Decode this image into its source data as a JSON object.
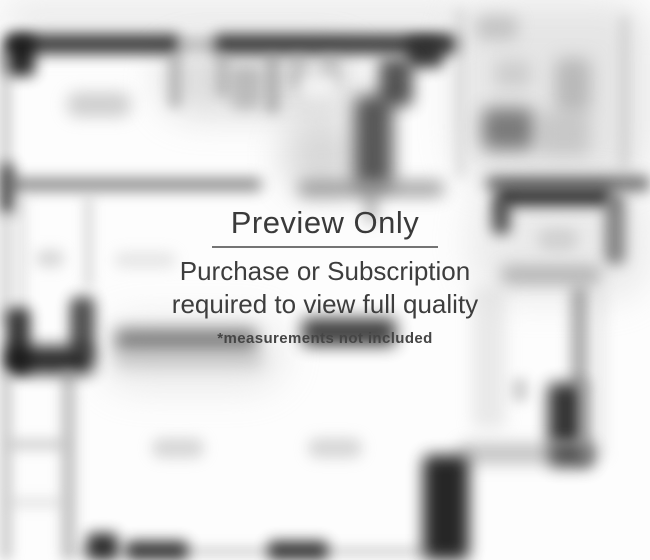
{
  "watermark": {
    "title": "Preview Only",
    "subtitle_line1": "Purchase or Subscription",
    "subtitle_line2": "required to view full quality",
    "note": "*measurements not included"
  },
  "colors": {
    "watermark_text": "#3b3b3b",
    "divider": "#5c5c5c",
    "background": "#fdfdfd",
    "wall_dark": "#1f1f1f",
    "wall_gray": "#8c8c8c"
  },
  "floorplan": {
    "description": "Blurred black-and-white apartment floor plan (preview quality)",
    "shapes": [
      {
        "n": "fog-top-strip",
        "x": 0,
        "y": 0,
        "w": 470,
        "h": 36,
        "c": "#d9d9d9",
        "o": 0.55,
        "b": 18,
        "r": 40
      },
      {
        "n": "fog-top-right",
        "x": 455,
        "y": 0,
        "w": 195,
        "h": 185,
        "c": "#c9c9c9",
        "o": 0.45,
        "b": 18,
        "r": 40
      },
      {
        "n": "fog-closet-area",
        "x": 160,
        "y": 48,
        "w": 200,
        "h": 68,
        "c": "#bdbdbd",
        "o": 0.5,
        "b": 18,
        "r": 40
      },
      {
        "n": "fog-center",
        "x": 282,
        "y": 118,
        "w": 78,
        "h": 76,
        "c": "#9e9e9e",
        "o": 0.4,
        "b": 18,
        "r": 40
      },
      {
        "n": "fog-right-mid",
        "x": 470,
        "y": 185,
        "w": 180,
        "h": 115,
        "c": "#cfcfcf",
        "o": 0.4,
        "b": 18,
        "r": 40
      },
      {
        "n": "fog-counter",
        "x": 100,
        "y": 318,
        "w": 185,
        "h": 72,
        "c": "#cfcfcf",
        "o": 0.4,
        "b": 18,
        "r": 40
      },
      {
        "n": "top-wall-left",
        "x": 8,
        "y": 34,
        "w": 172,
        "h": 20,
        "c": "#1f1f1f",
        "o": 0.85,
        "b": 7,
        "r": 6
      },
      {
        "n": "top-wall-gap",
        "x": 178,
        "y": 38,
        "w": 40,
        "h": 13,
        "c": "#808080",
        "o": 0.5,
        "b": 7,
        "r": 6
      },
      {
        "n": "top-wall-right",
        "x": 214,
        "y": 34,
        "w": 244,
        "h": 20,
        "c": "#1f1f1f",
        "o": 0.85,
        "b": 7,
        "r": 6
      },
      {
        "n": "top-left-corner",
        "x": 5,
        "y": 36,
        "w": 30,
        "h": 40,
        "c": "#141414",
        "o": 0.9,
        "b": 7,
        "r": 6
      },
      {
        "n": "left-wall-upper",
        "x": 0,
        "y": 50,
        "w": 11,
        "h": 120,
        "c": "#9a9a9a",
        "o": 0.5,
        "b": 6,
        "r": 4
      },
      {
        "n": "left-wall-dark",
        "x": 0,
        "y": 164,
        "w": 14,
        "h": 50,
        "c": "#1e1e1e",
        "o": 0.85,
        "b": 7,
        "r": 4
      },
      {
        "n": "mid-left-wall",
        "x": 6,
        "y": 178,
        "w": 256,
        "h": 13,
        "c": "#575757",
        "o": 0.7,
        "b": 7,
        "r": 6
      },
      {
        "n": "left-wall-lower",
        "x": 0,
        "y": 214,
        "w": 11,
        "h": 112,
        "c": "#a3a3a3",
        "o": 0.45,
        "b": 6,
        "r": 4
      },
      {
        "n": "left-wall-inner",
        "x": 16,
        "y": 196,
        "w": 11,
        "h": 140,
        "c": "#bababa",
        "o": 0.35,
        "b": 6,
        "r": 4
      },
      {
        "n": "small-room-wall",
        "x": 84,
        "y": 196,
        "w": 9,
        "h": 92,
        "c": "#a3a3a3",
        "o": 0.4,
        "b": 6,
        "r": 4
      },
      {
        "n": "bedroom-label",
        "x": 67,
        "y": 92,
        "w": 64,
        "h": 25,
        "c": "#a8a8a8",
        "o": 0.55,
        "b": 8,
        "r": 10
      },
      {
        "n": "small-room-label",
        "x": 36,
        "y": 250,
        "w": 28,
        "h": 17,
        "c": "#b0b0b0",
        "o": 0.5,
        "b": 7,
        "r": 8
      },
      {
        "n": "furniture-edge",
        "x": 114,
        "y": 252,
        "w": 62,
        "h": 16,
        "c": "#c2c2c2",
        "o": 0.4,
        "b": 7,
        "r": 8
      },
      {
        "n": "closet-stub-1",
        "x": 168,
        "y": 54,
        "w": 14,
        "h": 54,
        "c": "#8a8a8a",
        "o": 0.5,
        "b": 6,
        "r": 5
      },
      {
        "n": "closet-stub-2",
        "x": 215,
        "y": 54,
        "w": 15,
        "h": 43,
        "c": "#929292",
        "o": 0.45,
        "b": 6,
        "r": 5
      },
      {
        "n": "closet-blob",
        "x": 231,
        "y": 66,
        "w": 30,
        "h": 44,
        "c": "#8f8f8f",
        "o": 0.45,
        "b": 7,
        "r": 8
      },
      {
        "n": "closet-stub-3",
        "x": 265,
        "y": 54,
        "w": 15,
        "h": 60,
        "c": "#868686",
        "o": 0.5,
        "b": 6,
        "r": 5
      },
      {
        "n": "closet-stub-4",
        "x": 288,
        "y": 54,
        "w": 19,
        "h": 34,
        "c": "#9c9c9c",
        "o": 0.4,
        "b": 6,
        "r": 5
      },
      {
        "n": "closet-stub-5",
        "x": 321,
        "y": 54,
        "w": 20,
        "h": 34,
        "c": "#9c9c9c",
        "o": 0.4,
        "b": 6,
        "r": 5
      },
      {
        "n": "kitchen-label",
        "x": 301,
        "y": 75,
        "w": 38,
        "h": 24,
        "c": "#f4f4f4",
        "o": 0.9,
        "b": 7,
        "r": 10
      },
      {
        "n": "diag-wall-step-1",
        "x": 407,
        "y": 38,
        "w": 36,
        "h": 30,
        "c": "#262626",
        "o": 0.85,
        "b": 7,
        "r": 6
      },
      {
        "n": "diag-wall-step-2",
        "x": 379,
        "y": 58,
        "w": 34,
        "h": 48,
        "c": "#2b2b2b",
        "o": 0.8,
        "b": 8,
        "r": 6
      },
      {
        "n": "center-wall-blob",
        "x": 354,
        "y": 95,
        "w": 39,
        "h": 92,
        "c": "#2e2e2e",
        "o": 0.8,
        "b": 9,
        "r": 8
      },
      {
        "n": "center-wall",
        "x": 298,
        "y": 180,
        "w": 146,
        "h": 17,
        "c": "#6e6e6e",
        "o": 0.6,
        "b": 8,
        "r": 6
      },
      {
        "n": "center-wall-stub",
        "x": 363,
        "y": 185,
        "w": 16,
        "h": 38,
        "c": "#8a8a8a",
        "o": 0.5,
        "b": 7,
        "r": 5
      },
      {
        "n": "divider-vline",
        "x": 455,
        "y": 8,
        "w": 10,
        "h": 170,
        "c": "#bdbdbd",
        "o": 0.4,
        "b": 6,
        "r": 4
      },
      {
        "n": "bath-blob-1",
        "x": 476,
        "y": 15,
        "w": 42,
        "h": 25,
        "c": "#a3a3a3",
        "o": 0.5,
        "b": 8,
        "r": 8
      },
      {
        "n": "bath-blob-2",
        "x": 495,
        "y": 60,
        "w": 36,
        "h": 28,
        "c": "#b3b3b3",
        "o": 0.45,
        "b": 8,
        "r": 8
      },
      {
        "n": "bath-blob-3",
        "x": 482,
        "y": 108,
        "w": 52,
        "h": 42,
        "c": "#4f4f4f",
        "o": 0.7,
        "b": 9,
        "r": 8
      },
      {
        "n": "bath-blob-4",
        "x": 555,
        "y": 58,
        "w": 36,
        "h": 54,
        "c": "#8c8c8c",
        "o": 0.5,
        "b": 9,
        "r": 8
      },
      {
        "n": "bath-marks",
        "x": 538,
        "y": 112,
        "w": 52,
        "h": 44,
        "c": "#9c9c9c",
        "o": 0.4,
        "b": 9,
        "r": 8
      },
      {
        "n": "right-edge-vline",
        "x": 620,
        "y": 15,
        "w": 9,
        "h": 155,
        "c": "#b3b3b3",
        "o": 0.45,
        "b": 6,
        "r": 4
      },
      {
        "n": "right-room-wall-ext",
        "x": 486,
        "y": 176,
        "w": 164,
        "h": 15,
        "c": "#3a3a3a",
        "o": 0.7,
        "b": 7,
        "r": 5
      },
      {
        "n": "right-room-top-wall",
        "x": 497,
        "y": 188,
        "w": 114,
        "h": 18,
        "c": "#1b1b1b",
        "o": 0.88,
        "b": 7,
        "r": 6
      },
      {
        "n": "right-room-corner",
        "x": 492,
        "y": 198,
        "w": 18,
        "h": 36,
        "c": "#2a2a2a",
        "o": 0.8,
        "b": 7,
        "r": 6
      },
      {
        "n": "right-room-right-wall",
        "x": 605,
        "y": 194,
        "w": 20,
        "h": 70,
        "c": "#555555",
        "o": 0.7,
        "b": 7,
        "r": 6
      },
      {
        "n": "right-room-bottom-wall",
        "x": 501,
        "y": 265,
        "w": 100,
        "h": 20,
        "c": "#8a8a8a",
        "o": 0.55,
        "b": 8,
        "r": 6
      },
      {
        "n": "right-room-label",
        "x": 538,
        "y": 228,
        "w": 40,
        "h": 23,
        "c": "#b8b8b8",
        "o": 0.5,
        "b": 7,
        "r": 10
      },
      {
        "n": "right-lower-wall",
        "x": 571,
        "y": 287,
        "w": 17,
        "h": 100,
        "c": "#6e6e6e",
        "o": 0.6,
        "b": 7,
        "r": 5
      },
      {
        "n": "right-lower-wall-2",
        "x": 597,
        "y": 290,
        "w": 10,
        "h": 170,
        "c": "#c2c2c2",
        "o": 0.3,
        "b": 6,
        "r": 4
      },
      {
        "n": "right-dark-blob",
        "x": 548,
        "y": 383,
        "w": 35,
        "h": 62,
        "c": "#191919",
        "o": 0.88,
        "b": 8,
        "r": 6
      },
      {
        "n": "right-band",
        "x": 459,
        "y": 443,
        "w": 134,
        "h": 21,
        "c": "#8c8c8c",
        "o": 0.5,
        "b": 8,
        "r": 6
      },
      {
        "n": "right-band-dark",
        "x": 549,
        "y": 444,
        "w": 44,
        "h": 23,
        "c": "#2e2e2e",
        "o": 0.78,
        "b": 8,
        "r": 6
      },
      {
        "n": "right-column",
        "x": 472,
        "y": 287,
        "w": 34,
        "h": 142,
        "c": "#c5c5c5",
        "o": 0.35,
        "b": 8,
        "r": 6
      },
      {
        "n": "right-marks",
        "x": 512,
        "y": 378,
        "w": 16,
        "h": 24,
        "c": "#9c9c9c",
        "o": 0.45,
        "b": 6,
        "r": 5
      },
      {
        "n": "right-wall-low",
        "x": 579,
        "y": 380,
        "w": 13,
        "h": 84,
        "c": "#8c8c8c",
        "o": 0.45,
        "b": 6,
        "r": 4
      },
      {
        "n": "tub-upper",
        "x": 74,
        "y": 292,
        "w": 22,
        "h": 48,
        "c": "#b3b3b3",
        "o": 0.4,
        "b": 7,
        "r": 6
      },
      {
        "n": "tub-left",
        "x": 6,
        "y": 308,
        "w": 24,
        "h": 64,
        "c": "#1c1c1c",
        "o": 0.88,
        "b": 7,
        "r": 6
      },
      {
        "n": "tub-right",
        "x": 70,
        "y": 298,
        "w": 24,
        "h": 58,
        "c": "#2a2a2a",
        "o": 0.8,
        "b": 7,
        "r": 6
      },
      {
        "n": "tub-bottom",
        "x": 6,
        "y": 346,
        "w": 88,
        "h": 28,
        "c": "#151515",
        "o": 0.9,
        "b": 8,
        "r": 8
      },
      {
        "n": "hall-left-wall",
        "x": 0,
        "y": 372,
        "w": 12,
        "h": 188,
        "c": "#9c9c9c",
        "o": 0.5,
        "b": 6,
        "r": 4
      },
      {
        "n": "hall-inner-wall",
        "x": 61,
        "y": 370,
        "w": 15,
        "h": 190,
        "c": "#8c8c8c",
        "o": 0.5,
        "b": 6,
        "r": 4
      },
      {
        "n": "hall-rung-1",
        "x": 8,
        "y": 438,
        "w": 58,
        "h": 13,
        "c": "#ababab",
        "o": 0.45,
        "b": 6,
        "r": 5
      },
      {
        "n": "hall-rung-2",
        "x": 8,
        "y": 497,
        "w": 58,
        "h": 11,
        "c": "#c0c0c0",
        "o": 0.35,
        "b": 6,
        "r": 5
      },
      {
        "n": "counter-dark",
        "x": 115,
        "y": 328,
        "w": 142,
        "h": 24,
        "c": "#4f4f4f",
        "o": 0.65,
        "b": 8,
        "r": 6
      },
      {
        "n": "counter-light",
        "x": 115,
        "y": 352,
        "w": 148,
        "h": 17,
        "c": "#ababab",
        "o": 0.45,
        "b": 8,
        "r": 6
      },
      {
        "n": "entry-dark-bar",
        "x": 302,
        "y": 318,
        "w": 94,
        "h": 28,
        "c": "#222222",
        "o": 0.85,
        "b": 8,
        "r": 6
      },
      {
        "n": "living-label-1",
        "x": 152,
        "y": 438,
        "w": 52,
        "h": 20,
        "c": "#b0b0b0",
        "o": 0.5,
        "b": 7,
        "r": 9
      },
      {
        "n": "living-label-2",
        "x": 308,
        "y": 438,
        "w": 54,
        "h": 20,
        "c": "#b0b0b0",
        "o": 0.5,
        "b": 7,
        "r": 9
      },
      {
        "n": "bottom-wall-line",
        "x": 76,
        "y": 547,
        "w": 352,
        "h": 9,
        "c": "#9c9c9c",
        "o": 0.45,
        "b": 6,
        "r": 4
      },
      {
        "n": "bottom-dark-1",
        "x": 126,
        "y": 541,
        "w": 62,
        "h": 19,
        "c": "#1c1c1c",
        "o": 0.85,
        "b": 7,
        "r": 5
      },
      {
        "n": "bottom-dark-2",
        "x": 268,
        "y": 541,
        "w": 60,
        "h": 19,
        "c": "#1c1c1c",
        "o": 0.85,
        "b": 7,
        "r": 5
      },
      {
        "n": "bottom-corner-block",
        "x": 87,
        "y": 533,
        "w": 31,
        "h": 27,
        "c": "#161616",
        "o": 0.88,
        "b": 7,
        "r": 5
      },
      {
        "n": "bottom-pillar",
        "x": 423,
        "y": 455,
        "w": 46,
        "h": 105,
        "c": "#0f0f0f",
        "o": 0.9,
        "b": 8,
        "r": 7
      }
    ]
  }
}
